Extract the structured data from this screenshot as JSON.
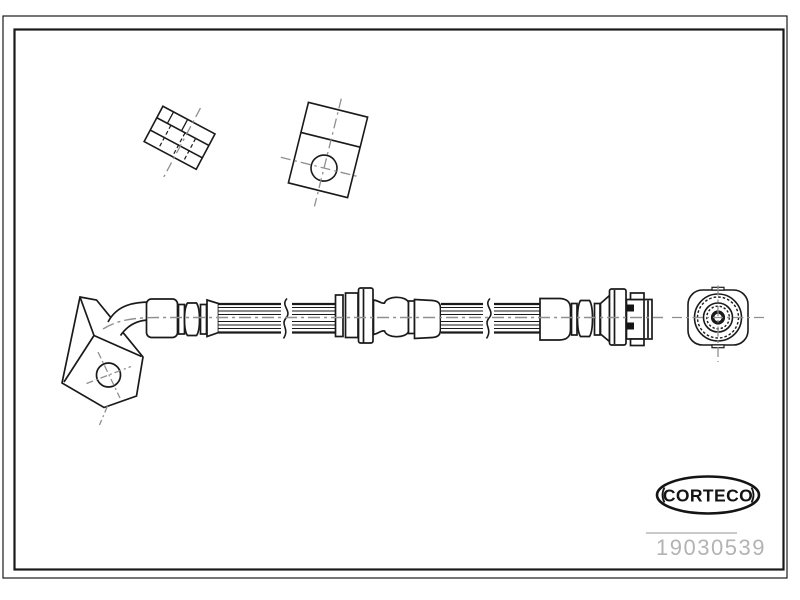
{
  "logo": {
    "text": "CORTECO"
  },
  "part_number": {
    "value": "19030539"
  },
  "colors": {
    "line": "#1a1a1a",
    "centerline": "#8f8f8f",
    "part_number": "#b3b3b3",
    "background": "#ffffff"
  },
  "drawing": {
    "views": [
      "mounting-clip-view",
      "mounting-bracket-view",
      "brake-hose-side-view",
      "fitting-end-view"
    ]
  }
}
